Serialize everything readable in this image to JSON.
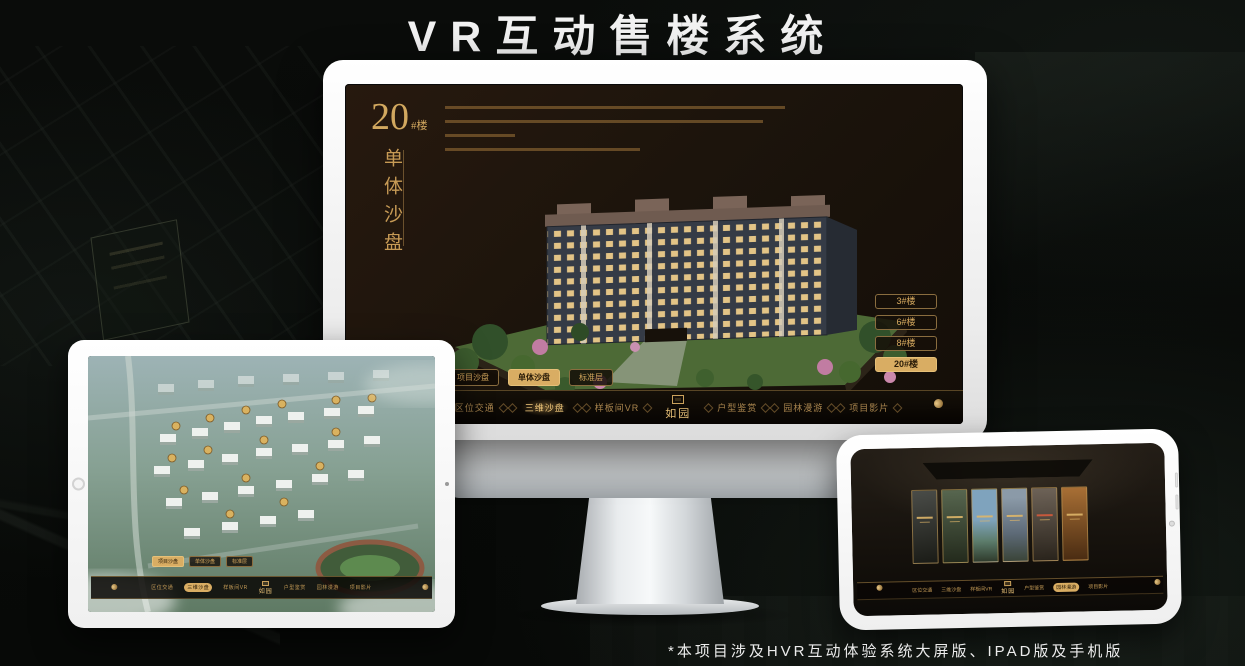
{
  "page": {
    "title": "VR互动售楼系统",
    "footnote": "*本项目涉及HVR互动体验系统大屏版、IPAD版及手机版"
  },
  "colors": {
    "accent_gold": "#d2a85f",
    "accent_gold_bright": "#ecc77c",
    "selected_pill_bg": "#d9ad63",
    "selected_pill_text": "#2a1c08",
    "screen_background": "#1c140c",
    "nav_background": "#0c0805",
    "title_text": "#f2f2f2"
  },
  "monitor": {
    "unit_title": {
      "number": "20",
      "suffix": "#楼"
    },
    "section_title": "单体沙盘",
    "floor_buttons": [
      {
        "label": "3#楼",
        "selected": false
      },
      {
        "label": "6#楼",
        "selected": false
      },
      {
        "label": "8#楼",
        "selected": false
      },
      {
        "label": "20#楼",
        "selected": true
      }
    ],
    "view_tabs": [
      {
        "label": "项目沙盘",
        "selected": false
      },
      {
        "label": "单体沙盘",
        "selected": true
      },
      {
        "label": "标准层",
        "selected": false
      }
    ],
    "nav": {
      "items_left": [
        "区位交通",
        "三维沙盘",
        "样板间VR"
      ],
      "logo": "如园",
      "items_right": [
        "户型鉴赏",
        "园林漫游",
        "项目影片"
      ],
      "active_item": "三维沙盘"
    }
  },
  "tablet": {
    "view_tabs": [
      {
        "label": "项目沙盘",
        "selected": true
      },
      {
        "label": "单体沙盘",
        "selected": false
      },
      {
        "label": "标准层",
        "selected": false
      }
    ],
    "nav": {
      "items_left": [
        "区位交通",
        "三维沙盘",
        "样板间VR"
      ],
      "logo": "如园",
      "items_right": [
        "户型鉴赏",
        "园林漫游",
        "项目影片"
      ],
      "active_item": "三维沙盘"
    }
  },
  "phone": {
    "nav": {
      "items_left": [
        "区位交通",
        "三维沙盘",
        "样板间VR"
      ],
      "logo": "如园",
      "items_right": [
        "户型鉴赏",
        "园林漫游",
        "项目影片"
      ],
      "active_item": "园林漫游"
    },
    "panels": [
      {
        "color": "#45473f"
      },
      {
        "color": "#4d5c44"
      },
      {
        "color": "#7fa3bd"
      },
      {
        "color": "#74828f"
      },
      {
        "color": "#5d5346"
      },
      {
        "color": "#a86f35"
      }
    ]
  }
}
